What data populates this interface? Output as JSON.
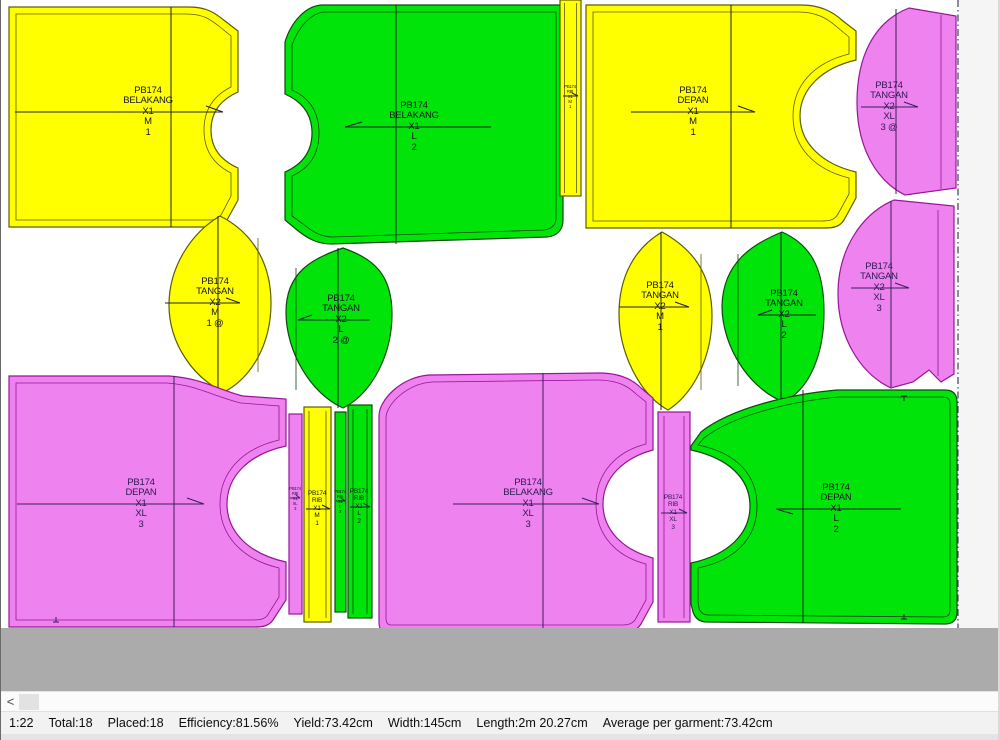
{
  "colors": {
    "piece_yellow": "#ffff00",
    "piece_green": "#00e40a",
    "piece_magenta": "#ee82ee",
    "stroke_yellow": "#5c5c00",
    "stroke_green": "#0c4a0c",
    "stroke_magenta": "#991499",
    "waste_band": "#ababab",
    "statusbar_bg": "#f2f2f2",
    "marker_line": "#3c3c5a"
  },
  "pieces": [
    {
      "part": "PB174",
      "name": "BELAKANG",
      "qty": "X1",
      "size": "M",
      "bundle": "1",
      "color": "yellow",
      "grain": "right"
    },
    {
      "part": "PB174",
      "name": "BELAKANG",
      "qty": "X1",
      "size": "L",
      "bundle": "2",
      "color": "green",
      "grain": "left"
    },
    {
      "part": "PB174",
      "name": "RIB",
      "qty": "X1",
      "size": "M",
      "bundle": "1",
      "color": "yellow",
      "grain": "right"
    },
    {
      "part": "PB174",
      "name": "DEPAN",
      "qty": "X1",
      "size": "M",
      "bundle": "1",
      "color": "yellow",
      "grain": "right"
    },
    {
      "part": "PB174",
      "name": "TANGAN",
      "qty": "X2",
      "size": "XL",
      "bundle": "3 @",
      "color": "magenta",
      "grain": "right"
    },
    {
      "part": "PB174",
      "name": "TANGAN",
      "qty": "X2",
      "size": "M",
      "bundle": "1 @",
      "color": "yellow",
      "grain": "right"
    },
    {
      "part": "PB174",
      "name": "TANGAN",
      "qty": "X2",
      "size": "L",
      "bundle": "2 @",
      "color": "green",
      "grain": "left"
    },
    {
      "part": "PB174",
      "name": "TANGAN",
      "qty": "X2",
      "size": "M",
      "bundle": "1",
      "color": "yellow",
      "grain": "right"
    },
    {
      "part": "PB174",
      "name": "TANGAN",
      "qty": "X2",
      "size": "L",
      "bundle": "2",
      "color": "green",
      "grain": "left"
    },
    {
      "part": "PB174",
      "name": "TANGAN",
      "qty": "X2",
      "size": "XL",
      "bundle": "3",
      "color": "magenta",
      "grain": "right"
    },
    {
      "part": "PB174",
      "name": "DEPAN",
      "qty": "X1",
      "size": "XL",
      "bundle": "3",
      "color": "magenta",
      "grain": "right"
    },
    {
      "part": "PB174",
      "name": "RIB",
      "qty": "X1",
      "size": "XL",
      "bundle": "3",
      "color": "magenta",
      "grain": "right"
    },
    {
      "part": "PB174",
      "name": "RIB",
      "qty": "X1",
      "size": "M",
      "bundle": "1",
      "color": "yellow",
      "grain": "right"
    },
    {
      "part": "PB174",
      "name": "RIB",
      "qty": "X1",
      "size": "L",
      "bundle": "2",
      "color": "green",
      "grain": "right"
    },
    {
      "part": "PB174",
      "name": "RIB",
      "qty": "X1",
      "size": "L",
      "bundle": "2",
      "color": "green",
      "grain": "right"
    },
    {
      "part": "PB174",
      "name": "BELAKANG",
      "qty": "X1",
      "size": "XL",
      "bundle": "3",
      "color": "magenta",
      "grain": "right"
    },
    {
      "part": "PB174",
      "name": "RIB",
      "qty": "X1",
      "size": "XL",
      "bundle": "3",
      "color": "magenta",
      "grain": "right"
    },
    {
      "part": "PB174",
      "name": "DEPAN",
      "qty": "X1",
      "size": "L",
      "bundle": "2",
      "color": "green",
      "grain": "left"
    }
  ],
  "status_bar": {
    "scale": "1:22",
    "total": "Total:18",
    "placed": "Placed:18",
    "efficiency": "Efficiency:81.56%",
    "yield": "Yield:73.42cm",
    "width": "Width:145cm",
    "length": "Length:2m 20.27cm",
    "average": "Average per garment:73.42cm"
  },
  "scrollbar": {
    "left_arrow": "<"
  }
}
